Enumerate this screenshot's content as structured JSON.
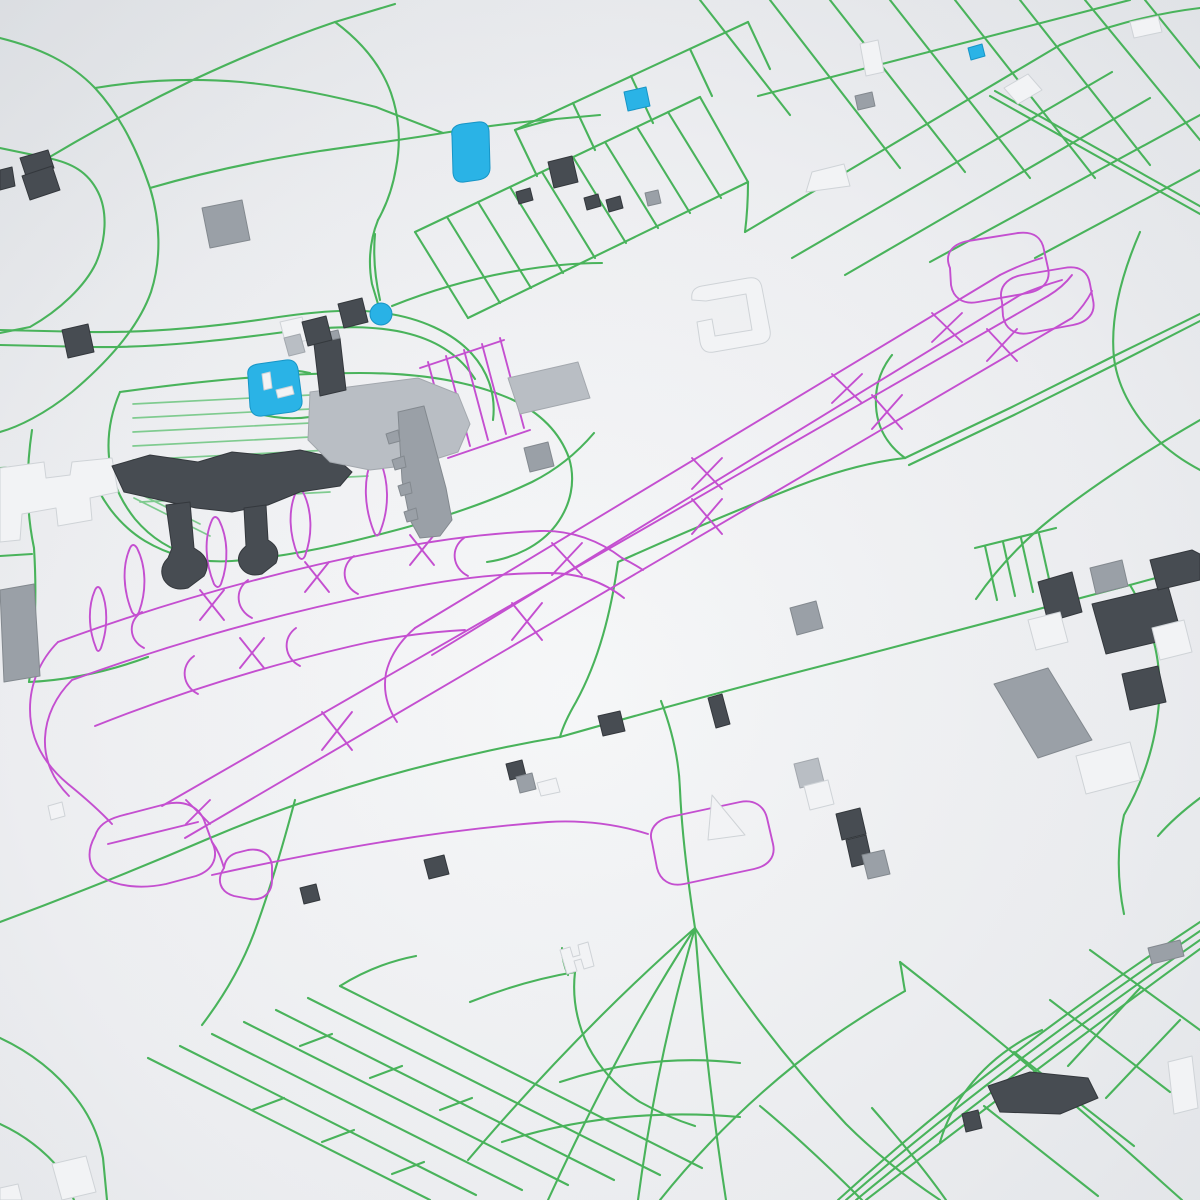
{
  "map": {
    "description": "3D rendered city map with airport, green roads, magenta taxiways, gray buildings",
    "palette": {
      "bg_center": "#f6f7f8",
      "bg_mid": "#e9ebee",
      "bg_edge": "#dcdfe3",
      "road": "#49b35b",
      "road_light": "#7fcb8f",
      "taxiway": "#c44fd0",
      "water": "#2ab3e6",
      "marker": "#29b2e6",
      "building_dark": "#474c52",
      "building_dark_stroke": "#34383d",
      "building_mid": "#9aa0a7",
      "building_mid_stroke": "#83898f",
      "building_light": "#b9bec4",
      "building_light_stroke": "#a3a8ae",
      "building_white": "#f2f3f5",
      "building_white_stroke": "#cfd3d7",
      "water_stroke": "#1795c6"
    },
    "marker": {
      "cx": 381,
      "cy": 314,
      "r": 11
    },
    "water": [
      "M 452 136 Q 450 126 462 124 L 478 122 Q 488 121 489 131 L 490 168 Q 490 178 478 180 L 464 182 Q 454 183 453 173 Z",
      "M 624 92 L 646 87 L 650 106 L 628 111 Z",
      "M 248 376 Q 246 366 258 364 L 286 360 Q 296 359 298 369 L 302 400 Q 303 410 292 412 L 262 416 Q 252 417 250 407 Z",
      "M 968 48 L 982 44 L 985 56 L 971 60 Z"
    ],
    "roads_major": [
      "M 0 38 C 40 48 70 62 95 88 C 120 115 138 152 150 188 C 160 220 162 258 151 292 C 139 326 110 360 72 392 C 45 414 18 427 0 432",
      "M 0 148 L 48 158 C 72 163 88 172 98 192 C 108 212 106 240 96 263 C 85 286 60 310 30 327 L 0 333",
      "M 48 158 C 95 130 145 103 195 79 C 240 58 288 38 335 22 L 395 4",
      "M 150 188 C 205 172 262 160 320 151 C 360 145 402 140 443 133",
      "M 95 88 C 142 80 192 78 241 82 C 283 86 330 95 376 107 L 443 133",
      "M 443 133 C 480 127 518 122 556 119 L 600 115",
      "M 335 22 C 362 42 381 65 391 93 C 399 116 401 142 396 168 C 393 186 387 204 378 220",
      "M 378 220 C 370 240 368 262 372 284 L 381 314",
      "M 415 232 L 700 97",
      "M 468 318 L 748 182",
      "M 415 232 L 468 318",
      "M 447 217 L 500 303",
      "M 478 202 L 531 288",
      "M 510 187 L 563 273",
      "M 542 172 L 595 258",
      "M 573 157 L 626 243",
      "M 605 142 L 658 228",
      "M 637 127 L 690 213",
      "M 668 112 L 721 198",
      "M 700 97 L 748 182",
      "M 515 130 L 748 22",
      "M 515 130 L 537 176",
      "M 573 103 L 595 150",
      "M 631 76 L 653 123",
      "M 690 49 L 712 96",
      "M 748 22 L 770 69",
      "M 556 119 C 542 122 528 126 515 130",
      "M 745 232 L 1060 45",
      "M 792 258 L 1112 72",
      "M 845 275 L 1150 98",
      "M 930 262 L 1200 115",
      "M 1035 258 L 1200 170",
      "M 758 96 L 1130 0",
      "M 770 0 L 900 168",
      "M 830 0 L 965 172",
      "M 890 0 L 1030 178",
      "M 955 0 L 1095 178",
      "M 1020 0 L 1150 165",
      "M 1085 0 L 1200 140",
      "M 1145 0 L 1200 68",
      "M 700 0 L 790 115",
      "M 1060 45 C 1100 28 1150 14 1200 8",
      "M 990 96 L 1200 214",
      "M 995 91 L 1205 209",
      "M 748 182 C 748 199 747 216 745 232",
      "M 1140 232 C 1120 278 1110 320 1114 358 C 1118 390 1136 418 1160 442",
      "M 1160 442 C 1175 456 1189 464 1200 470",
      "M 905 458 L 1010 408 L 1110 358 L 1200 314",
      "M 909 465 L 1014 415 L 1114 365 L 1200 321",
      "M 905 458 C 886 444 877 426 876 406 C 875 388 880 370 892 355",
      "M 618 562 C 680 534 740 509 798 486 C 834 472 870 462 905 458",
      "M 618 562 C 611 612 599 660 576 702 C 569 714 563 726 560 737",
      "M 560 737 C 655 710 750 684 845 660 C 940 635 1035 610 1130 585 L 1200 566",
      "M 975 548 L 1056 528",
      "M 985 546 L 997 600",
      "M 1003 542 L 1015 596",
      "M 1021 538 L 1033 592",
      "M 1039 534 L 1051 588",
      "M 1200 420 C 1148 450 1098 482 1052 518 C 1022 542 996 570 976 599",
      "M 1130 585 C 1152 622 1162 662 1159 702 C 1156 742 1144 780 1124 815 C 1117 845 1117 880 1124 914",
      "M 1200 798 C 1184 810 1170 822 1158 836",
      "M 0 330 L 88 332 C 150 333 212 327 272 318 C 312 312 352 308 384 313 C 420 318 452 332 472 354 C 489 373 496 396 493 420",
      "M 0 345 L 90 347 C 158 348 226 340 292 331 C 338 326 376 325 410 334 C 440 342 461 357 475 379",
      "M 392 306 C 432 290 474 278 516 271 C 545 266 574 263 602 263",
      "M 380 300 C 375 278 373 256 375 234",
      "M 312 330 C 331 344 341 361 343 381 C 345 400 339 418 327 433",
      "M 252 371 C 272 369 292 369 310 373",
      "M 256 413 C 280 420 305 420 327 413",
      "M 120 392 C 200 381 280 373 360 373 C 420 373 470 381 511 399 C 541 413 560 433 569 458 C 576 481 571 505 556 525 C 540 546 514 558 487 562",
      "M 120 392 C 111 413 107 435 109 457 C 111 479 120 500 135 519 C 151 538 172 551 196 557",
      "M 90 470 C 100 500 119 525 145 541 C 172 557 202 563 232 561 C 290 557 348 543 404 528 C 448 516 492 501 532 482 C 556 470 577 453 594 433",
      "M 32 430 C 26 470 26 510 34 548 C 36 580 36 612 33 644 C 32 658 31 670 29 682",
      "M 0 468 L 34 466",
      "M 0 556 L 32 554",
      "M 29 682 C 70 680 110 671 148 657",
      "M 0 922 C 70 896 140 868 210 838 C 292 803 380 775 470 755 C 500 748 530 742 560 737",
      "M 295 800 C 283 845 270 890 254 933 C 242 965 224 996 202 1025",
      "M 470 1002 C 505 988 540 978 575 972",
      "M 575 972 C 572 998 577 1023 588 1046 C 600 1069 618 1088 640 1102 C 658 1112 676 1120 695 1126",
      "M 568 975 C 564 966 562 957 562 948",
      "M 0 1038 C 30 1052 56 1072 76 1098 C 90 1116 99 1136 103 1158 L 107 1200",
      "M 0 1124 C 26 1136 46 1152 62 1172 L 74 1200",
      "M 148 1058 L 430 1200",
      "M 180 1046 L 476 1195",
      "M 212 1034 L 522 1190",
      "M 244 1022 L 568 1185",
      "M 276 1010 L 614 1180",
      "M 308 998 L 660 1175",
      "M 340 986 L 702 1168",
      "M 252 1110 L 284 1098",
      "M 322 1142 L 354 1130",
      "M 392 1174 L 424 1162",
      "M 300 1046 L 332 1034",
      "M 370 1078 L 402 1066",
      "M 440 1110 L 472 1098",
      "M 340 986 C 364 971 390 961 416 956",
      "M 695 928 C 640 1012 592 1104 548 1200",
      "M 695 928 C 615 998 538 1078 468 1160",
      "M 695 928 C 668 1020 650 1110 638 1200",
      "M 695 928 C 702 1020 712 1110 726 1200",
      "M 695 928 C 740 1000 790 1064 846 1124 C 878 1156 910 1180 940 1200",
      "M 560 1082 C 620 1062 680 1056 740 1063",
      "M 502 1142 C 580 1117 660 1110 740 1117",
      "M 695 928 C 688 882 682 836 680 790 C 679 760 672 730 661 701",
      "M 1200 922 C 1070 1008 950 1098 838 1200",
      "M 1200 931 C 1075 1016 955 1105 846 1200",
      "M 1200 940 C 1080 1024 962 1112 856 1200",
      "M 1200 949 C 1086 1032 970 1120 866 1200",
      "M 1042 1030 C 1012 1044 987 1063 968 1088 C 955 1104 946 1122 940 1142",
      "M 900 962 C 990 1032 1078 1106 1164 1184 L 1182 1200",
      "M 1090 950 L 1200 1030",
      "M 1050 1000 L 1170 1092",
      "M 1014 1052 L 1134 1146",
      "M 984 1106 L 1098 1196",
      "M 1140 988 L 1068 1066",
      "M 1180 1020 L 1106 1098",
      "M 872 1108 C 900 1140 925 1170 946 1200",
      "M 760 1106 C 796 1136 830 1168 862 1200",
      "M 660 1200 C 700 1150 746 1104 796 1064 C 830 1037 867 1013 905 991",
      "M 905 991 C 903 981 902 971 900 962"
    ],
    "roads_light": [
      "M 133 404 L 370 392",
      "M 133 418 L 370 406",
      "M 133 432 L 370 420",
      "M 133 446 L 370 434",
      "M 133 460 L 370 448",
      "M 133 474 L 370 462",
      "M 133 488 L 368 476",
      "M 140 502 L 330 492",
      "M 124 486 L 200 524",
      "M 134 498 L 210 536"
    ],
    "taxiways": [
      "M 185 838 L 1072 318",
      "M 162 806 L 1048 296",
      "M 415 628 L 1000 275",
      "M 432 655 L 1020 295",
      "M 322 712 L 352 750",
      "M 352 712 L 322 750",
      "M 512 603 L 542 640",
      "M 542 603 L 512 640",
      "M 692 499 L 722 534",
      "M 722 499 L 692 534",
      "M 872 395 L 902 429",
      "M 902 395 L 872 429",
      "M 987 329 L 1017 361",
      "M 1017 329 L 987 361",
      "M 552 543 L 582 575",
      "M 582 543 L 552 575",
      "M 692 458 L 722 489",
      "M 722 458 L 692 489",
      "M 832 374 L 862 403",
      "M 862 374 L 832 403",
      "M 932 313 L 962 342",
      "M 962 313 L 932 342",
      "M 950 268 C 944 254 952 244 968 241 L 1018 233 C 1034 231 1042 238 1044 250 L 1048 268 C 1051 281 1043 290 1028 293 L 978 302 C 962 305 953 297 951 285 Z",
      "M 1002 302 C 998 288 1006 278 1022 275 L 1064 268 C 1080 265 1088 272 1090 284 L 1093 300 C 1096 313 1088 322 1073 325 L 1030 333 C 1014 336 1005 328 1003 316 Z",
      "M 1000 275 C 1014 268 1028 262 1042 258",
      "M 1020 295 C 1034 289 1048 284 1062 280",
      "M 1048 296 C 1058 290 1066 283 1072 275",
      "M 1072 318 C 1080 310 1087 301 1092 291",
      "M 95 836 C 86 852 88 868 102 877 C 118 887 142 889 166 884 L 196 876 C 214 870 219 856 212 842 L 204 820 C 198 806 184 800 166 804 L 120 816 C 106 820 98 826 95 836 Z",
      "M 108 844 L 198 822",
      "M 224 868 C 216 880 220 892 234 896 L 250 899 C 264 901 272 892 272 880 L 272 866 C 271 854 261 848 248 850 L 236 853 C 228 856 225 861 224 868 Z",
      "M 186 800 L 210 824",
      "M 210 800 L 186 824",
      "M 212 842 C 218 850 221 858 224 868",
      "M 212 875 C 330 849 440 830 548 822 C 582 820 616 824 648 834",
      "M 652 842 C 648 830 656 820 670 817 L 740 802 C 754 799 764 806 767 818 L 773 844 C 776 857 768 866 754 869 L 684 884 C 670 887 660 880 657 868 Z",
      "M 58 642 C 170 601 282 570 392 549 C 442 539 492 533 540 531 C 572 530 600 541 622 558",
      "M 72 680 C 182 640 292 610 402 589 C 452 579 502 573 548 573 C 578 573 604 582 624 598",
      "M 95 726 C 180 692 266 666 352 646 C 390 637 428 632 465 630",
      "M 142 612 C 128 620 128 640 144 648",
      "M 248 580 C 234 590 236 610 252 618",
      "M 354 556 C 340 566 342 586 358 594",
      "M 464 538 C 450 548 452 568 468 576",
      "M 194 656 C 180 666 182 686 198 694",
      "M 296 628 C 282 638 284 658 300 666",
      "M 200 590 L 224 620",
      "M 224 590 L 200 620",
      "M 305 562 L 329 592",
      "M 329 562 L 305 592",
      "M 410 535 L 434 565",
      "M 434 535 L 410 565",
      "M 240 638 L 264 668",
      "M 264 638 L 240 668",
      "M 58 642 C 40 660 30 684 30 709 C 30 739 44 764 68 784 C 84 797 99 810 112 824",
      "M 72 680 C 56 696 46 716 45 738 C 44 760 53 780 69 796",
      "M 415 628 C 400 641 390 656 386 673 C 383 690 387 707 397 722",
      "M 622 558 C 630 562 637 566 643 570",
      "M 96 648 C 88 628 88 606 95 590 Q 98 584 101 590 C 108 606 108 628 101 648 Q 98 654 96 648 Z",
      "M 132 612 C 123 590 122 566 130 548 Q 133 542 137 548 C 146 566 147 590 139 612 Q 136 618 132 612 Z",
      "M 214 584 C 205 562 204 538 212 520 Q 215 514 219 520 C 228 538 229 562 221 584 Q 218 590 214 584 Z",
      "M 298 556 C 289 534 288 510 296 492 Q 299 486 303 492 C 312 510 313 534 305 556 Q 302 562 298 556 Z",
      "M 374 532 C 364 507 363 480 372 458 Q 375 451 379 458 C 389 480 390 507 380 532 Q 377 539 374 532 Z",
      "M 428 362 L 452 452",
      "M 446 356 L 470 446",
      "M 464 350 L 488 440",
      "M 482 344 L 506 434",
      "M 500 338 L 524 428",
      "M 420 368 L 504 340",
      "M 448 458 L 530 430"
    ],
    "buildings": [
      {
        "fill": "white",
        "d": "M 0 468 L 44 462 L 46 478 L 70 475 L 72 462 L 112 458 L 118 492 L 90 498 L 92 520 L 58 526 L 56 508 L 22 514 L 20 540 L 0 542 Z"
      },
      {
        "fill": "dark",
        "d": "M 112 466 L 150 455 L 198 462 L 232 452 L 262 455 L 300 450 L 336 458 L 352 472 L 340 486 L 300 492 L 268 505 L 232 512 L 196 508 L 160 500 L 124 492 Z"
      },
      {
        "fill": "dark",
        "d": "M 166 505 L 190 502 L 194 548 L 200 552 Q 212 562 204 576 L 188 588 Q 172 592 164 580 Q 158 568 168 558 L 172 548 Z"
      },
      {
        "fill": "dark",
        "d": "M 244 508 L 266 505 L 268 540 Q 282 548 276 563 L 262 574 Q 247 578 240 566 Q 235 555 246 546 Z"
      },
      {
        "fill": "light",
        "d": "M 310 392 L 418 378 L 458 394 L 470 424 L 458 452 L 420 464 L 370 470 L 330 462 L 308 440 Z"
      },
      {
        "fill": "mid",
        "d": "M 398 412 L 424 406 L 446 488 L 452 520 L 440 536 L 420 538 L 410 520 L 402 480 Z"
      },
      {
        "fill": "mid",
        "d": "M 398 430 L 386 434 L 389 444 L 400 441 Z"
      },
      {
        "fill": "mid",
        "d": "M 404 456 L 392 460 L 395 470 L 406 467 Z"
      },
      {
        "fill": "mid",
        "d": "M 410 482 L 398 486 L 401 496 L 412 493 Z"
      },
      {
        "fill": "mid",
        "d": "M 416 508 L 404 512 L 407 522 L 418 519 Z"
      },
      {
        "fill": "light",
        "d": "M 508 378 L 578 362 L 590 398 L 520 414 Z"
      },
      {
        "fill": "mid",
        "d": "M 524 448 L 548 442 L 554 466 L 530 472 Z"
      },
      {
        "fill": "dark",
        "d": "M 314 344 L 340 338 L 346 390 L 320 396 Z"
      },
      {
        "fill": "mid",
        "d": "M 312 336 L 338 330 L 340 338 L 314 344 Z"
      },
      {
        "fill": "dark",
        "d": "M 338 304 L 362 298 L 368 322 L 344 328 Z"
      },
      {
        "fill": "white",
        "d": "M 280 322 L 302 317 L 308 340 L 286 345 Z"
      },
      {
        "fill": "light",
        "d": "M 284 338 L 300 334 L 305 352 L 289 356 Z"
      },
      {
        "fill": "dark",
        "d": "M 302 322 L 326 316 L 332 340 L 308 346 Z"
      },
      {
        "fill": "dark",
        "d": "M 20 158 L 48 150 L 54 168 L 26 176 Z"
      },
      {
        "fill": "dark",
        "d": "M 22 176 L 52 166 L 60 190 L 30 200 Z"
      },
      {
        "fill": "dark",
        "d": "M 0 170 L 12 167 L 15 186 L 0 190 Z"
      },
      {
        "fill": "dark",
        "d": "M 62 330 L 88 324 L 94 352 L 68 358 Z"
      },
      {
        "fill": "mid",
        "d": "M 202 208 L 242 200 L 250 240 L 210 248 Z"
      },
      {
        "fill": "dark",
        "d": "M 548 162 L 572 156 L 578 182 L 554 188 Z"
      },
      {
        "fill": "dark",
        "d": "M 584 198 L 598 194 L 601 206 L 587 210 Z"
      },
      {
        "fill": "dark",
        "d": "M 606 200 L 620 196 L 623 208 L 609 212 Z"
      },
      {
        "fill": "dark",
        "d": "M 516 192 L 530 188 L 533 200 L 519 204 Z"
      },
      {
        "fill": "mid",
        "d": "M 645 193 L 658 190 L 661 203 L 648 206 Z"
      },
      {
        "fill": "white",
        "d": "M 692 300 Q 690 288 702 286 L 748 278 Q 760 276 762 288 L 770 330 Q 772 342 760 344 L 714 352 Q 702 354 700 342 L 697 322 L 712 319 L 715 336 L 752 330 L 746 294 L 706 301 Z"
      },
      {
        "fill": "white",
        "d": "M 812 172 L 844 164 L 850 186 L 806 192 Z"
      },
      {
        "fill": "mid",
        "d": "M 855 96 L 872 92 L 875 106 L 858 110 Z"
      },
      {
        "fill": "white",
        "d": "M 860 44 L 878 40 L 884 72 L 866 76 Z"
      },
      {
        "fill": "white",
        "d": "M 1004 88 L 1028 74 L 1042 90 L 1018 104 Z"
      },
      {
        "fill": "white",
        "d": "M 1130 22 L 1158 16 L 1162 32 L 1134 38 Z"
      },
      {
        "fill": "mid",
        "d": "M 0 590 L 34 584 L 40 676 L 4 682 Z"
      },
      {
        "fill": "white",
        "d": "M 48 806 L 62 802 L 65 816 L 51 820 Z"
      },
      {
        "fill": "dark",
        "d": "M 1038 582 L 1072 572 L 1082 612 L 1048 622 Z"
      },
      {
        "fill": "dark",
        "d": "M 1092 604 L 1168 586 L 1182 636 L 1106 654 Z"
      },
      {
        "fill": "dark",
        "d": "M 1150 560 L 1192 550 L 1200 554 L 1200 580 L 1158 590 Z"
      },
      {
        "fill": "dark",
        "d": "M 1122 674 L 1158 666 L 1166 702 L 1130 710 Z"
      },
      {
        "fill": "white",
        "d": "M 1028 620 L 1060 612 L 1068 642 L 1036 650 Z"
      },
      {
        "fill": "mid",
        "d": "M 994 684 L 1048 668 L 1092 740 L 1038 758 Z"
      },
      {
        "fill": "white",
        "d": "M 1076 756 L 1130 742 L 1140 780 L 1086 794 Z"
      },
      {
        "fill": "white",
        "d": "M 1152 628 L 1184 620 L 1192 652 L 1160 660 Z"
      },
      {
        "fill": "mid",
        "d": "M 1090 568 L 1122 560 L 1128 586 L 1096 594 Z"
      },
      {
        "fill": "mid",
        "d": "M 790 608 L 816 601 L 823 628 L 797 635 Z"
      },
      {
        "fill": "dark",
        "d": "M 708 698 L 722 694 L 730 724 L 716 728 Z"
      },
      {
        "fill": "dark",
        "d": "M 598 716 L 620 711 L 625 731 L 603 736 Z"
      },
      {
        "fill": "light",
        "d": "M 794 764 L 818 758 L 824 782 L 800 788 Z"
      },
      {
        "fill": "white",
        "d": "M 804 786 L 828 780 L 834 804 L 810 810 Z"
      },
      {
        "fill": "dark",
        "d": "M 836 814 L 860 808 L 866 834 L 842 840 Z"
      },
      {
        "fill": "dark",
        "d": "M 846 840 L 866 835 L 872 862 L 852 867 Z"
      },
      {
        "fill": "mid",
        "d": "M 862 855 L 884 850 L 890 874 L 868 879 Z"
      },
      {
        "fill": "white",
        "d": "M 708 840 L 712 795 L 745 835 Z"
      },
      {
        "fill": "dark",
        "d": "M 506 764 L 522 760 L 526 776 L 510 780 Z"
      },
      {
        "fill": "mid",
        "d": "M 516 777 L 532 773 L 536 789 L 520 793 Z"
      },
      {
        "fill": "white",
        "d": "M 537 783 L 556 778 L 560 792 L 541 796 Z"
      },
      {
        "fill": "dark",
        "d": "M 424 860 L 444 855 L 449 874 L 429 879 Z"
      },
      {
        "fill": "dark",
        "d": "M 300 888 L 316 884 L 320 900 L 304 904 Z"
      },
      {
        "fill": "white",
        "d": "M 560 950 L 570 947 L 573 957 L 580 955 L 578 945 L 588 942 L 594 966 L 584 969 L 581 959 L 574 961 L 577 971 L 567 974 Z"
      },
      {
        "fill": "dark",
        "d": "M 988 1086 L 1030 1072 L 1088 1078 L 1098 1098 L 1060 1114 L 1000 1112 Z"
      },
      {
        "fill": "dark",
        "d": "M 962 1114 L 978 1110 L 982 1128 L 966 1132 Z"
      },
      {
        "fill": "mid",
        "d": "M 1148 948 L 1180 940 L 1184 956 L 1152 964 Z"
      },
      {
        "fill": "white",
        "d": "M 1168 1062 L 1192 1056 L 1198 1108 L 1174 1114 Z"
      },
      {
        "fill": "white",
        "d": "M 52 1164 L 86 1156 L 96 1192 L 62 1200 Z"
      },
      {
        "fill": "white",
        "d": "M 0 1188 L 18 1184 L 22 1200 L 0 1200 Z"
      },
      {
        "fill": "white",
        "d": "M 262 374 L 270 372 L 272 388 L 264 390 Z"
      },
      {
        "fill": "white",
        "d": "M 276 390 L 292 386 L 294 394 L 278 398 Z"
      }
    ]
  }
}
